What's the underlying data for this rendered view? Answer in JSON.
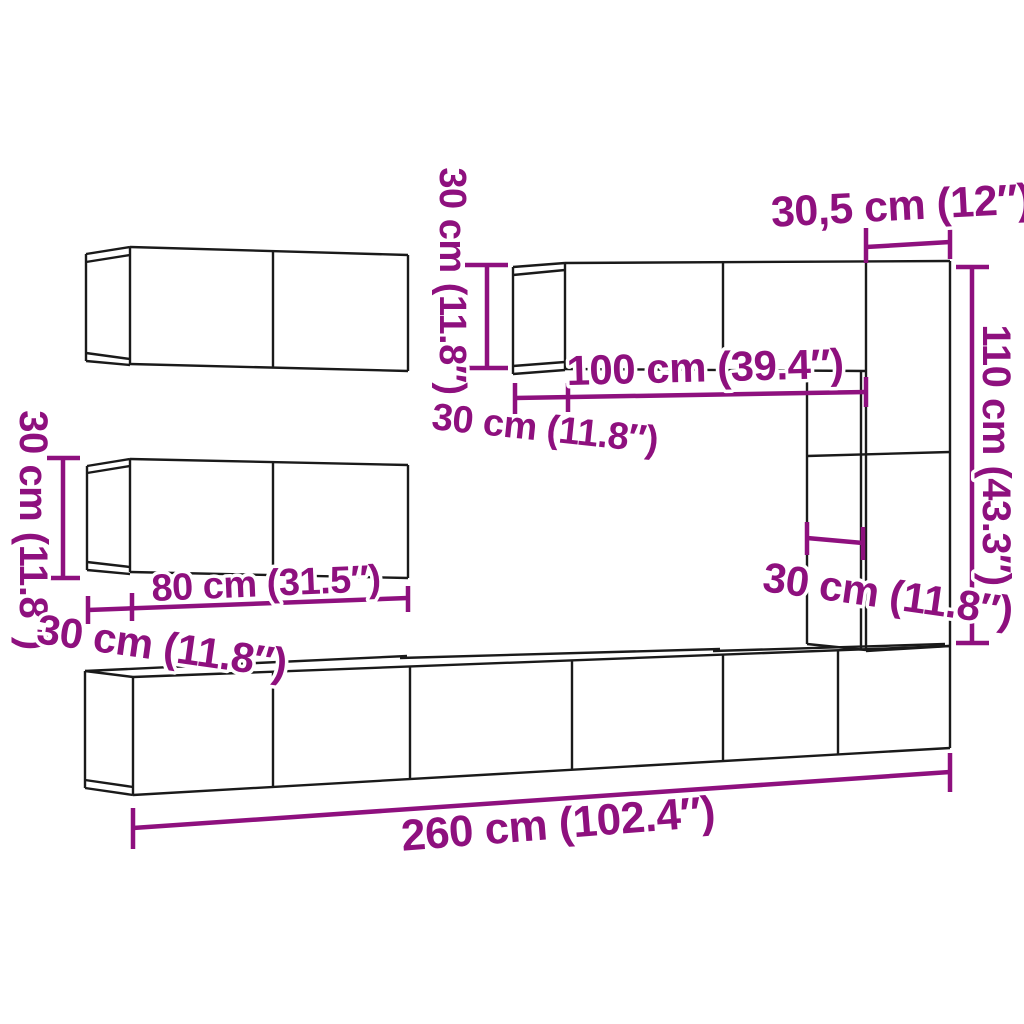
{
  "page": {
    "background": "#ffffff"
  },
  "diagram": {
    "colors": {
      "structure": "#1a1a1a",
      "dimension": "#8e107e",
      "halo": "#ffffff"
    },
    "labels": [
      {
        "id": "label-left-cabinet-height",
        "text": "30 cm (11.8″)",
        "x": 33,
        "y": 530,
        "rotate": 90,
        "size": 40
      },
      {
        "id": "label-left-cabinet-width",
        "text": "80 cm (31.5″)",
        "x": 266,
        "y": 584,
        "rotate": -2.5,
        "size": 38
      },
      {
        "id": "label-left-cabinet-depth",
        "text": "30 cm (11.8″)",
        "x": 162,
        "y": 646,
        "rotate": 8,
        "size": 42
      },
      {
        "id": "label-top-cabinet-height",
        "text": "30 cm (11.8″)",
        "x": 452,
        "y": 281,
        "rotate": 90,
        "size": 38
      },
      {
        "id": "label-top-cabinet-width",
        "text": "100 cm (39.4″)",
        "x": 705,
        "y": 367,
        "rotate": -1.5,
        "size": 42
      },
      {
        "id": "label-top-cabinet-depth",
        "text": "30 cm (11.8″)",
        "x": 545,
        "y": 429,
        "rotate": 6,
        "size": 38
      },
      {
        "id": "label-column-width",
        "text": "30,5 cm (12″)",
        "x": 901,
        "y": 206,
        "rotate": -3,
        "size": 43
      },
      {
        "id": "label-column-height",
        "text": "110 cm (43.3″)",
        "x": 996,
        "y": 455,
        "rotate": 90,
        "size": 40
      },
      {
        "id": "label-column-depth",
        "text": "30 cm (11.8″)",
        "x": 888,
        "y": 594,
        "rotate": 8,
        "size": 42
      },
      {
        "id": "label-total-width",
        "text": "260 cm (102.4″)",
        "x": 558,
        "y": 824,
        "rotate": -4.5,
        "size": 44
      }
    ],
    "structure_lines": [
      [
        130,
        247,
        408,
        255
      ],
      [
        408,
        255,
        408,
        371
      ],
      [
        130,
        364,
        408,
        371
      ],
      [
        130,
        247,
        130,
        364
      ],
      [
        273,
        251,
        273,
        367
      ],
      [
        86,
        254,
        130,
        247
      ],
      [
        86,
        262,
        130,
        255
      ],
      [
        86,
        254,
        86,
        361
      ],
      [
        86,
        353,
        130,
        359
      ],
      [
        86,
        361,
        130,
        365
      ],
      [
        130,
        459,
        408,
        465
      ],
      [
        408,
        465,
        408,
        578
      ],
      [
        130,
        572,
        408,
        578
      ],
      [
        130,
        459,
        130,
        572
      ],
      [
        273,
        462,
        273,
        575
      ],
      [
        87,
        466,
        130,
        459
      ],
      [
        87,
        473,
        130,
        466
      ],
      [
        87,
        466,
        87,
        570
      ],
      [
        87,
        562,
        130,
        567
      ],
      [
        87,
        570,
        130,
        574
      ],
      [
        513,
        267,
        565,
        263
      ],
      [
        565,
        263,
        950,
        261
      ],
      [
        513,
        267,
        513,
        374
      ],
      [
        513,
        275,
        565,
        270
      ],
      [
        513,
        366,
        565,
        362
      ],
      [
        513,
        374,
        565,
        370
      ],
      [
        565,
        263,
        565,
        370
      ],
      [
        565,
        369,
        866,
        371
      ],
      [
        723,
        262,
        723,
        370
      ],
      [
        866,
        262,
        866,
        651
      ],
      [
        861,
        371,
        861,
        649
      ],
      [
        807,
        369,
        807,
        644
      ],
      [
        807,
        456,
        950,
        452
      ],
      [
        950,
        261,
        950,
        646
      ],
      [
        807,
        644,
        866,
        650
      ],
      [
        866,
        651,
        950,
        646
      ],
      [
        85,
        671,
        407,
        656
      ],
      [
        400,
        658,
        720,
        649
      ],
      [
        713,
        651,
        945,
        644
      ],
      [
        133,
        677,
        950,
        646
      ],
      [
        85,
        671,
        85,
        788
      ],
      [
        85,
        671,
        133,
        677
      ],
      [
        85,
        788,
        133,
        795
      ],
      [
        85,
        780,
        133,
        787
      ],
      [
        133,
        677,
        133,
        795
      ],
      [
        133,
        795,
        950,
        748
      ],
      [
        950,
        646,
        950,
        748
      ],
      [
        273,
        672,
        273,
        787
      ],
      [
        410,
        667,
        410,
        779
      ],
      [
        572,
        661,
        572,
        770
      ],
      [
        723,
        655,
        723,
        761
      ],
      [
        838,
        651,
        838,
        755
      ]
    ],
    "dimension_lines": [
      [
        63,
        458,
        63,
        578
      ],
      [
        47,
        458,
        80,
        458
      ],
      [
        47,
        578,
        80,
        578
      ],
      [
        88,
        610,
        408,
        598
      ],
      [
        88,
        596,
        88,
        624
      ],
      [
        132,
        593,
        132,
        621
      ],
      [
        408,
        586,
        408,
        612
      ],
      [
        487,
        265,
        487,
        368
      ],
      [
        465,
        265,
        508,
        265
      ],
      [
        465,
        368,
        508,
        368
      ],
      [
        515,
        398,
        866,
        392
      ],
      [
        515,
        383,
        515,
        414
      ],
      [
        568,
        383,
        568,
        412
      ],
      [
        866,
        377,
        866,
        407
      ],
      [
        866,
        247,
        950,
        242
      ],
      [
        866,
        228,
        866,
        263
      ],
      [
        950,
        224,
        950,
        259
      ],
      [
        972,
        267,
        972,
        643
      ],
      [
        956,
        267,
        989,
        267
      ],
      [
        956,
        643,
        989,
        643
      ],
      [
        807,
        538,
        863,
        543
      ],
      [
        807,
        522,
        807,
        555
      ],
      [
        863,
        527,
        863,
        560
      ],
      [
        133,
        828,
        950,
        772
      ],
      [
        133,
        808,
        133,
        849
      ],
      [
        950,
        753,
        950,
        792
      ]
    ]
  }
}
